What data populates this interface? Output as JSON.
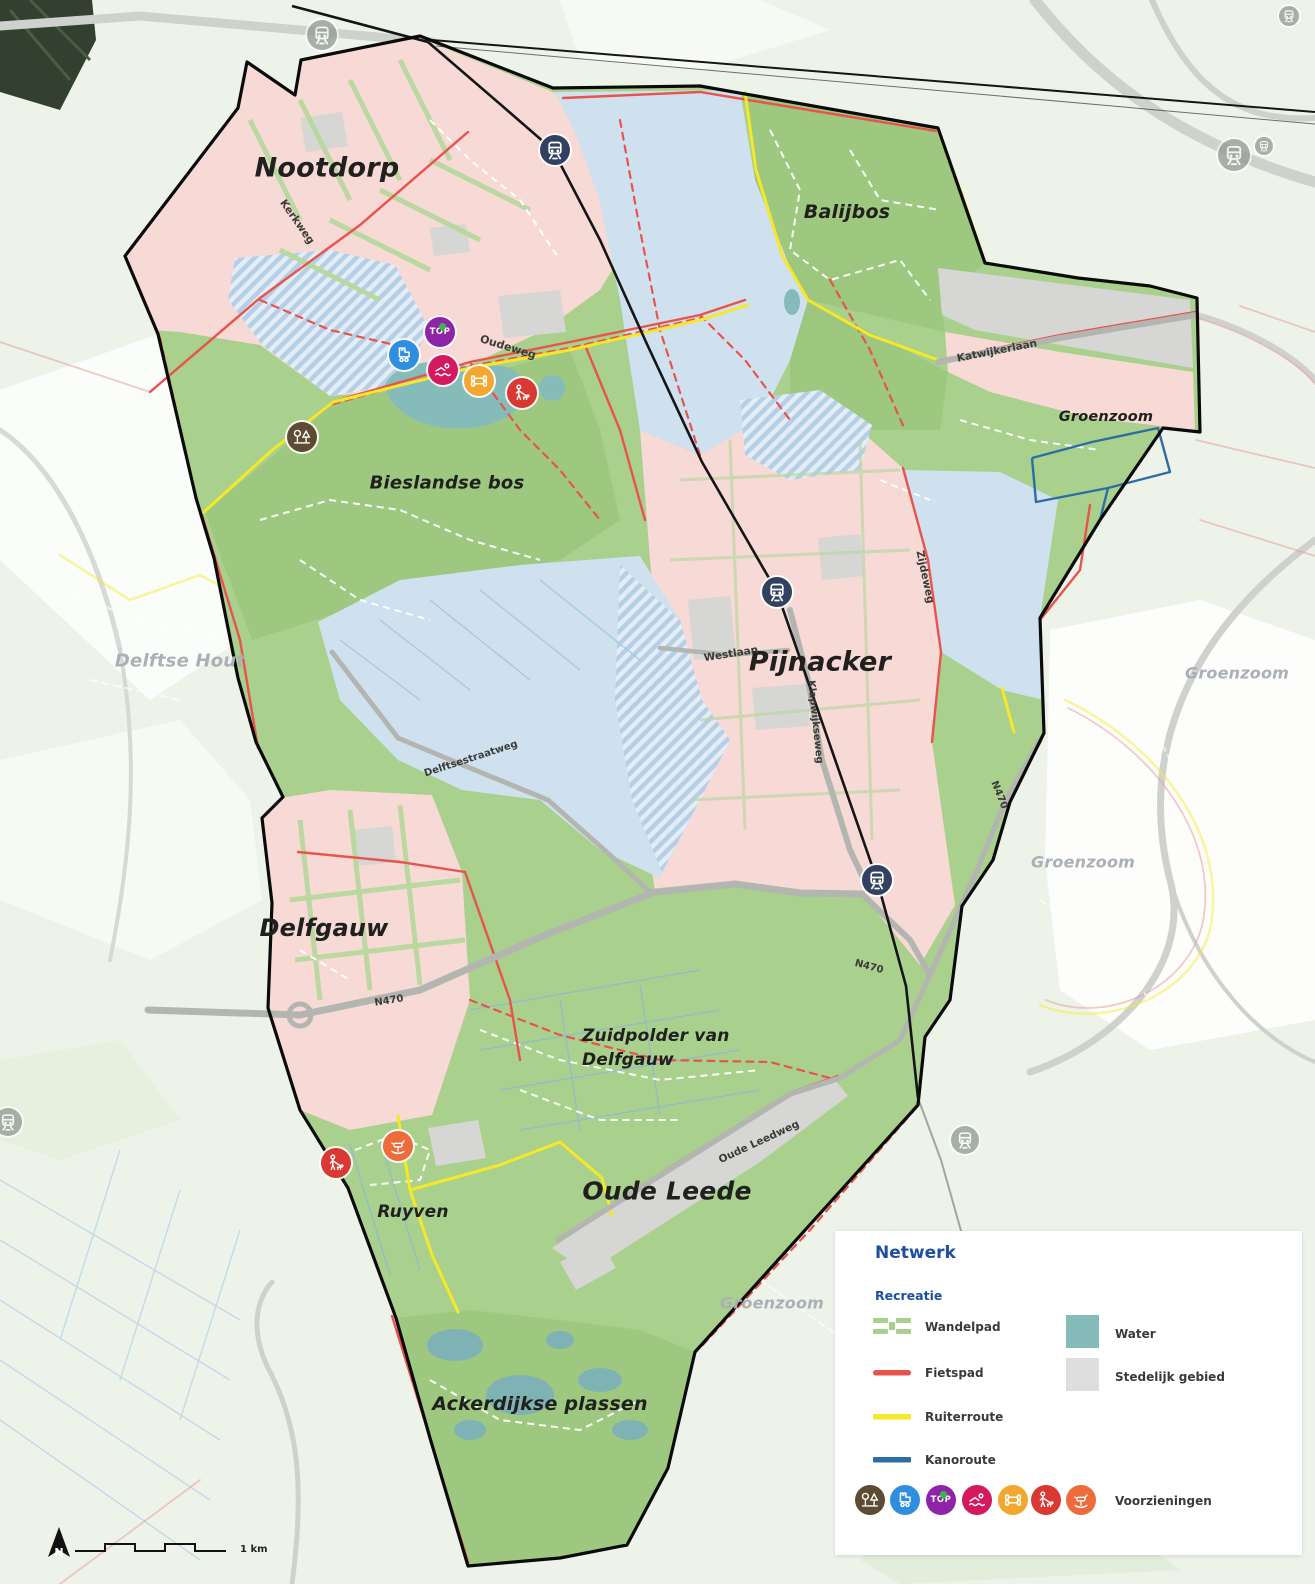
{
  "map": {
    "place_labels": [
      {
        "text": "Nootdorp"
      },
      {
        "text": "Balijbos"
      },
      {
        "text": "Groenzoom"
      },
      {
        "text": "Bieslandse bos"
      },
      {
        "text": "Delftse Hout"
      },
      {
        "text": "Pijnacker"
      },
      {
        "text": "Groenzoom"
      },
      {
        "text": "Groenzoom"
      },
      {
        "text": "Delfgauw"
      },
      {
        "text": "Zuidpolder van"
      },
      {
        "text": "Delfgauw"
      },
      {
        "text": "Ruyven"
      },
      {
        "text": "Oude Leede"
      },
      {
        "text": "Groenzoom"
      },
      {
        "text": "Ackerdijkse plassen"
      }
    ],
    "road_labels": [
      {
        "text": "Kerkweg"
      },
      {
        "text": "Oudeweg"
      },
      {
        "text": "Katwijkerlaan"
      },
      {
        "text": "Zijdeweg"
      },
      {
        "text": "Westlaan"
      },
      {
        "text": "Klapwijkseweg"
      },
      {
        "text": "Delftsestraatweg"
      },
      {
        "text": "N470"
      },
      {
        "text": "N470"
      },
      {
        "text": "N470"
      },
      {
        "text": "Oude Leedweg"
      }
    ]
  },
  "palette": {
    "outside_bg": "#eef3ea",
    "nature_green": "#aad08d",
    "forest_green": "#9cc77e",
    "urban_pink": "#f7d9d5",
    "glass_blue": "#cfe1ef",
    "stedelijk": "#d6d6d4",
    "water": "#85bcba",
    "pond_teal": "#7fb2b4",
    "boundary": "#0b0b0b",
    "railway": "#151515",
    "fietspad": "#e8544d",
    "ruiterroute": "#f6e829",
    "kanoroute": "#2e6da4",
    "wandelpad_map": "#ffffff",
    "road_gray": "#b3b6b0",
    "legend_blue": "#1d4f9e"
  },
  "icons": {
    "top_label": "TOP",
    "station_color": "#32415f"
  },
  "legend": {
    "title": "Netwerk",
    "section": "Recreatie",
    "lines": [
      {
        "label": "Wandelpad",
        "color": "#a9d18e"
      },
      {
        "label": "Fietspad",
        "color": "#e8544d"
      },
      {
        "label": "Ruiterroute",
        "color": "#f6e829"
      },
      {
        "label": "Kanoroute",
        "color": "#2e6da4"
      }
    ],
    "areas": [
      {
        "label": "Water",
        "color": "#85bcba"
      },
      {
        "label": "Stedelijk gebied",
        "color": "#dedede"
      }
    ],
    "voorzieningen": {
      "label": "Voorzieningen",
      "icon_colors": [
        {
          "name": "park",
          "color": "#5d4b33"
        },
        {
          "name": "skate",
          "color": "#2f8ee0"
        },
        {
          "name": "top",
          "color": "#8e24a8"
        },
        {
          "name": "swim",
          "color": "#d6185e"
        },
        {
          "name": "fitness",
          "color": "#f3a72e"
        },
        {
          "name": "dog",
          "color": "#da3832"
        },
        {
          "name": "playground",
          "color": "#ee6b3b"
        }
      ]
    }
  },
  "scalebar": {
    "north_label": "N",
    "distance_label": "1 km"
  }
}
